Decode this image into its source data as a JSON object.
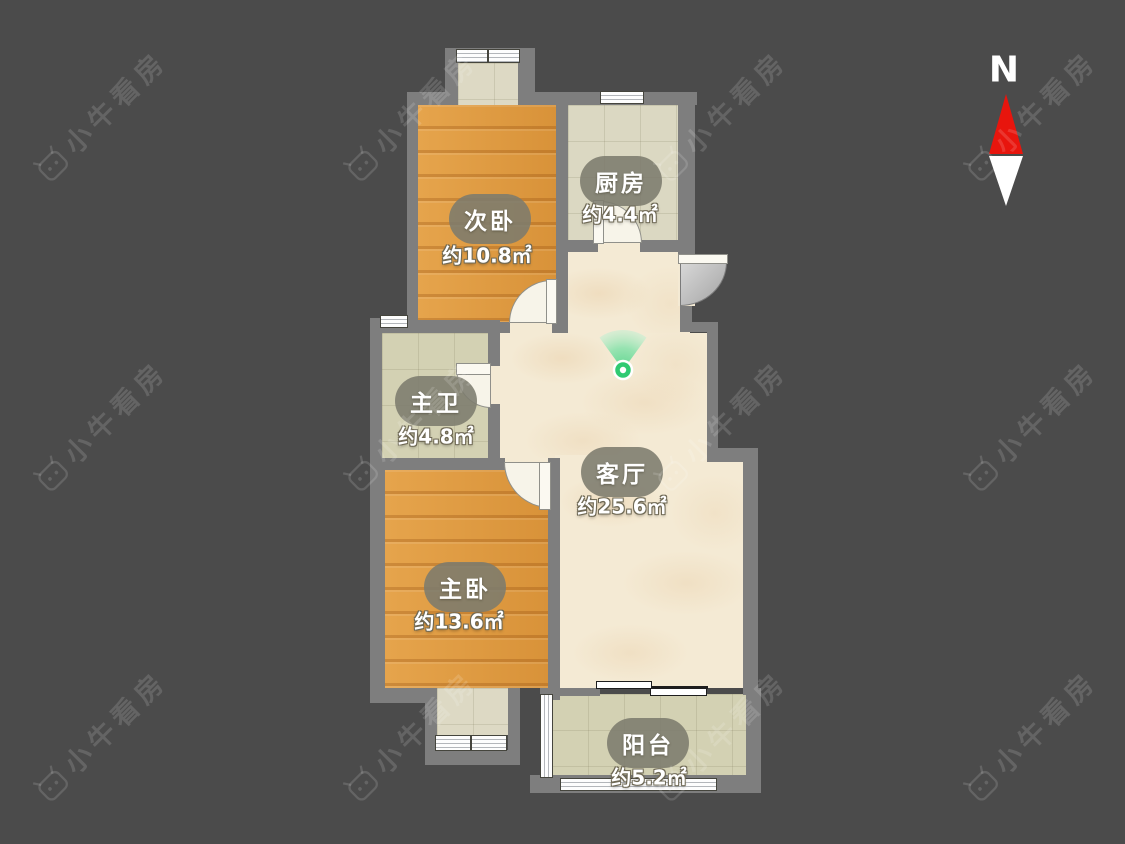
{
  "watermark": {
    "text": "小牛看房"
  },
  "compass": {
    "label": "N"
  },
  "viewpoint": {
    "name": "panorama-viewpoint",
    "color": "#2fca72"
  },
  "rooms": [
    {
      "name": "次卧",
      "area": "约10.8㎡",
      "floor": "wood"
    },
    {
      "name": "厨房",
      "area": "约4.4㎡",
      "floor": "tile"
    },
    {
      "name": "主卫",
      "area": "约4.8㎡",
      "floor": "tile"
    },
    {
      "name": "客厅",
      "area": "约25.6㎡",
      "floor": "marble"
    },
    {
      "name": "主卧",
      "area": "约13.6㎡",
      "floor": "wood"
    },
    {
      "name": "阳台",
      "area": "约5.2㎡",
      "floor": "tile"
    }
  ],
  "colors": {
    "background": "#4b4b4b",
    "wall": "#7e7e7e",
    "wood_floor": "#e09a3e",
    "tile_floor": "#d8d5bf",
    "marble_floor": "#f4ead4",
    "label_pill": "#7c7b6d",
    "accent_green": "#2fca72",
    "north_arrow_red": "#e8150d"
  }
}
